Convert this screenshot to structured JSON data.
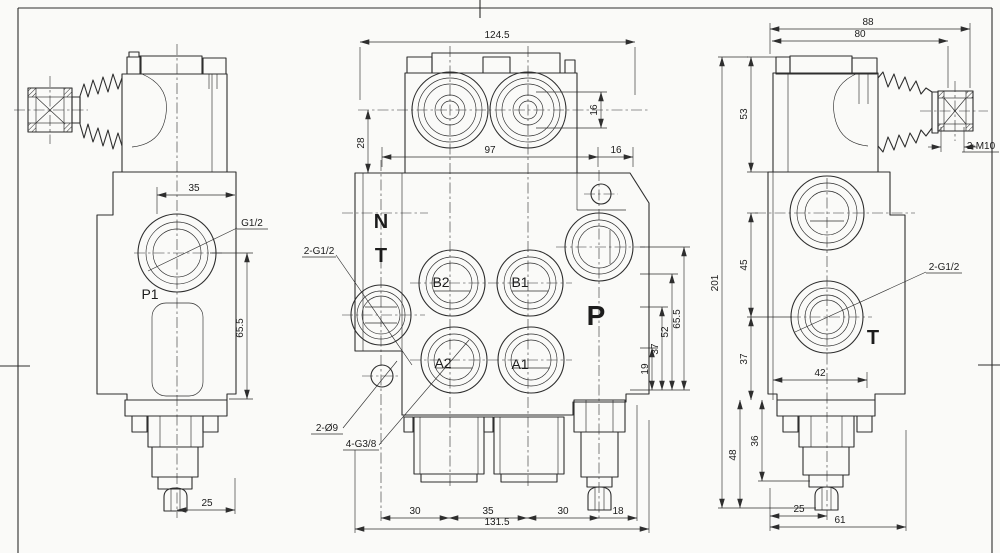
{
  "sheet": {
    "background": "#fafaf8",
    "line_color": "#2e2e2e"
  },
  "left_view": {
    "dim_35": "35",
    "port_g12": "G1/2",
    "p1": "P1",
    "dim_65_5": "65.5",
    "dim_25": "25"
  },
  "top_view": {
    "dim_124_5": "124.5",
    "dim_28": "28",
    "dim_16_vert": "16",
    "dim_97": "97",
    "dim_16_horiz": "16"
  },
  "front_view": {
    "label_n": "N",
    "label_t": "T",
    "label_b2": "B2",
    "label_b1": "B1",
    "label_a2": "A2",
    "label_a1": "A1",
    "label_p": "P",
    "leader_2_g12": "2-G1/2",
    "leader_2_d9": "2-Ø9",
    "leader_4_g38": "4-G3/8",
    "dim_19": "19",
    "dim_37": "37",
    "dim_52": "52",
    "dim_65_5": "65.5",
    "dim_30_left": "30",
    "dim_35": "35",
    "dim_30_right": "30",
    "dim_18": "18",
    "dim_131_5": "131.5"
  },
  "right_view": {
    "dim_88": "88",
    "dim_80": "80",
    "dim_53": "53",
    "dim_201": "201",
    "dim_45": "45",
    "dim_37": "37",
    "dim_42": "42",
    "dim_48": "48",
    "dim_36": "36",
    "dim_25": "25",
    "dim_61": "61",
    "label_t": "T",
    "leader_2_g12": "2-G1/2",
    "leader_2_m10": "2-M10"
  }
}
